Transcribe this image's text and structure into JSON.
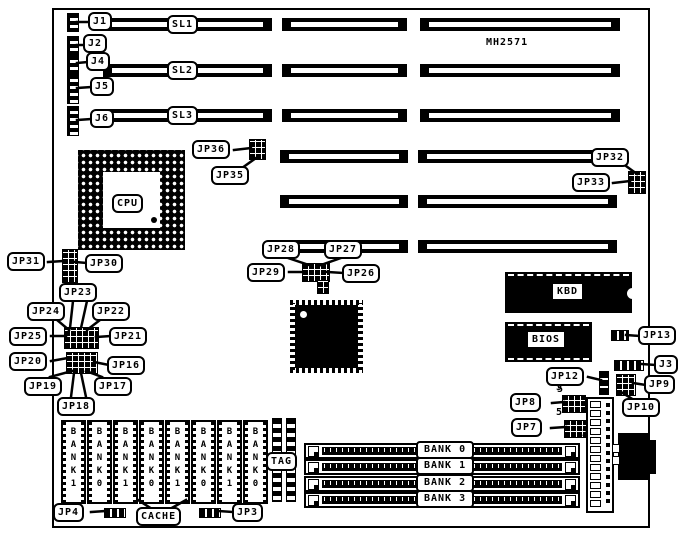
{
  "title": "MH2571",
  "callouts": {
    "j1": "J1",
    "j2": "J2",
    "j4": "J4",
    "j5": "J5",
    "j6": "J6",
    "sl1": "SL1",
    "sl2": "SL2",
    "sl3": "SL3",
    "jp36": "JP36",
    "jp35": "JP35",
    "jp32": "JP32",
    "jp33": "JP33",
    "jp31": "JP31",
    "jp30": "JP30",
    "jp23": "JP23",
    "jp24": "JP24",
    "jp22": "JP22",
    "jp25": "JP25",
    "jp21": "JP21",
    "jp20": "JP20",
    "jp16": "JP16",
    "jp19": "JP19",
    "jp17": "JP17",
    "jp18": "JP18",
    "jp28": "JP28",
    "jp27": "JP27",
    "jp29": "JP29",
    "jp26": "JP26",
    "jp13": "JP13",
    "j3": "J3",
    "jp12": "JP12",
    "jp9": "JP9",
    "jp10": "JP10",
    "jp8": "JP8",
    "jp7": "JP7",
    "jp4": "JP4",
    "jp3": "JP3",
    "cache": "CACHE",
    "tag": "TAG"
  },
  "chips": {
    "cpu": "CPU",
    "kbd": "KBD",
    "bios": "BIOS"
  },
  "simm_banks": [
    "BANK 0",
    "BANK 1",
    "BANK 2",
    "BANK 3"
  ],
  "cache_chips": [
    "BANK1",
    "BANK0",
    "BANK1",
    "BANK0",
    "BANK1",
    "BANK0",
    "BANK1",
    "BANK0"
  ],
  "pin_annotations": {
    "jp12_pin5": "5",
    "jp8_pin5": "5",
    "jp8_pin2": "2",
    "jp7_pin5": "5",
    "jp7_pin2": "2"
  },
  "colors": {
    "ink": "#000000",
    "paper": "#ffffff"
  }
}
